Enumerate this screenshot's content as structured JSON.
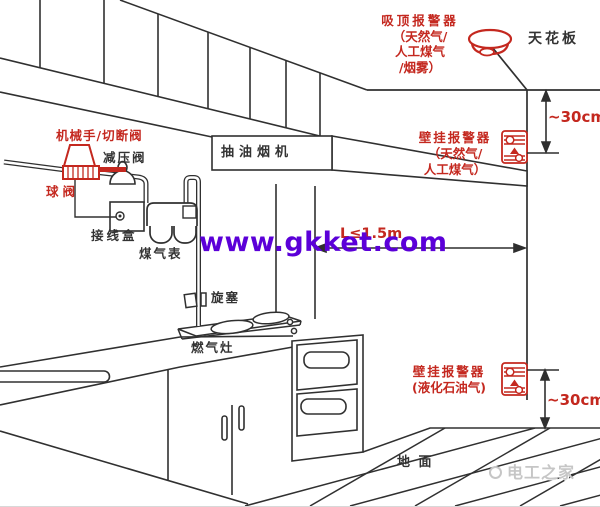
{
  "colors": {
    "label_red": "#c4281f",
    "line_black": "#333333",
    "watermark_purple": "#5b00d8",
    "watermark_gray": "#c6c6c6"
  },
  "diagram": {
    "ceiling_label": "天花板",
    "ground_label": "地 面",
    "ceiling_detector": {
      "title": "吸顶报警器",
      "sub1": "（天然气/",
      "sub2": "人工煤气",
      "sub3": "/烟雾）"
    },
    "wall_alarm_upper": {
      "title": "壁挂报警器",
      "sub1": "（天然气/",
      "sub2": "人工煤气）"
    },
    "wall_alarm_lower": {
      "title": "壁挂报警器",
      "sub1": "(液化石油气)"
    },
    "dimensions": {
      "top_offset": "~30cm",
      "bottom_offset": "~30cm",
      "horizontal": "L≤1.5m"
    },
    "appliances": {
      "hood": "抽油烟机",
      "stove": "燃气灶"
    },
    "gas_line": {
      "mech_valve": "机械手/切断阀",
      "pressure_valve": "减压阀",
      "ball_valve": "球阀",
      "junction_box": "接线盒",
      "gas_meter": "煤气表",
      "plug_valve": "旋塞"
    }
  },
  "watermarks": {
    "site": "www.gkket.com",
    "brand": "电工之家"
  }
}
